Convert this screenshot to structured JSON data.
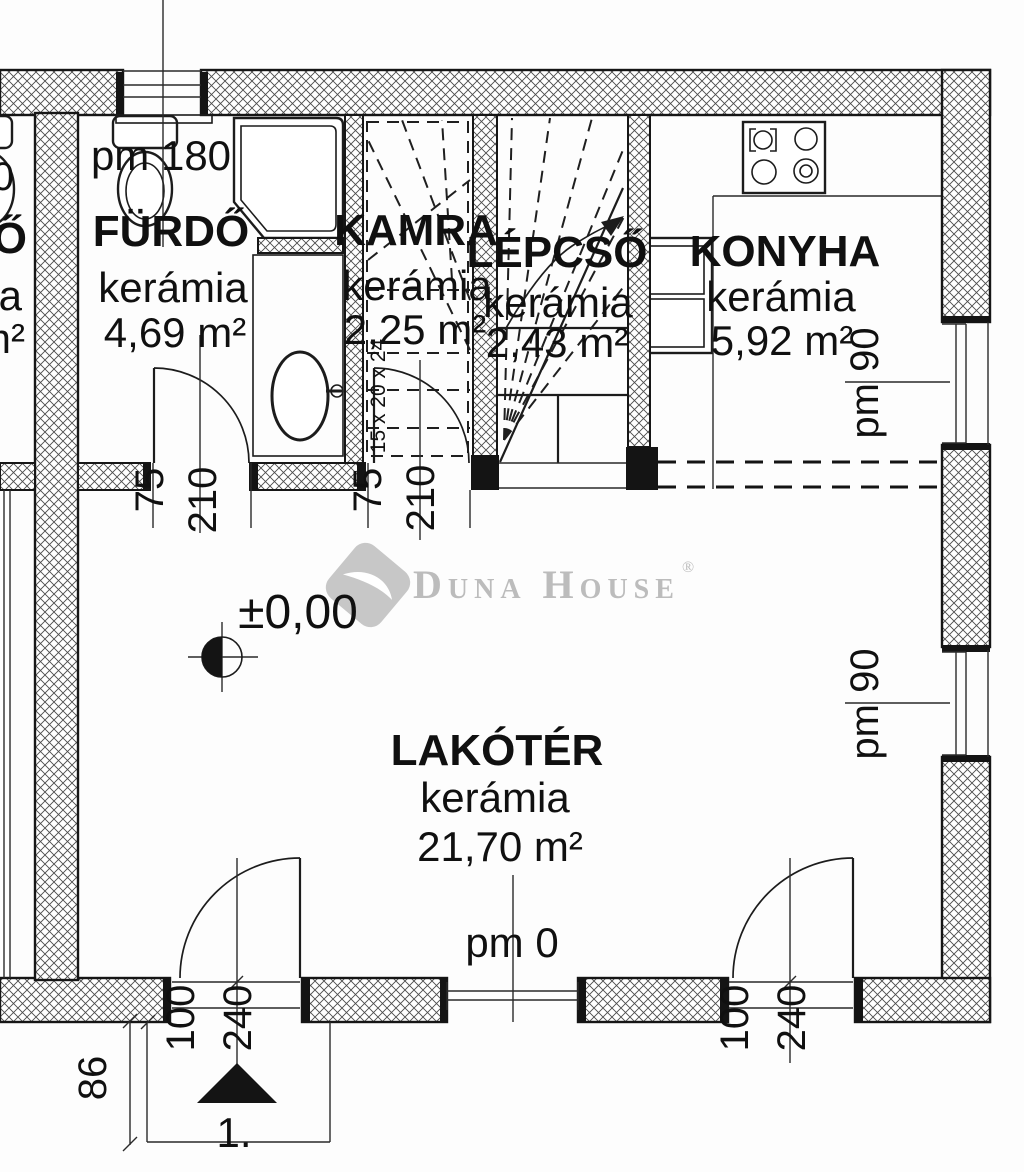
{
  "watermark": {
    "brand": "Duna House",
    "registered": "®"
  },
  "levels": {
    "floor_zero": "±0,00"
  },
  "rooms": {
    "furdo": {
      "name": "FÜRDŐ",
      "material": "kerámia",
      "area": "4,69 m²"
    },
    "kamra": {
      "name": "KAMRA",
      "material": "kerámia",
      "area": "2,25 m²"
    },
    "lepcso": {
      "name": "LÉPCSŐ",
      "material": "kerámia",
      "area": "2,43 m²"
    },
    "konyha": {
      "name": "KONYHA",
      "material": "kerámia",
      "area": "5,92 m²"
    },
    "lakoter": {
      "name": "LAKÓTÉR",
      "material": "kerámia",
      "area": "21,70 m²"
    }
  },
  "labels": {
    "pm180": "pm 180",
    "pm90_upper": "pm 90",
    "pm90_lower": "pm 90",
    "pm0": "pm 0",
    "stair_formula": "15 x 20 x 24",
    "entrance_number": "1.",
    "dim_86": "86"
  },
  "door_dimensions": {
    "furdo_w": "75",
    "furdo_h": "210",
    "kamra_w": "75",
    "kamra_h": "210",
    "entry_left_w": "100",
    "entry_left_h": "240",
    "entry_right_w": "100",
    "entry_right_h": "240"
  },
  "adjacent_unit_fragments": {
    "top": "0",
    "name": "Ő",
    "material": "a",
    "area": "m²"
  }
}
